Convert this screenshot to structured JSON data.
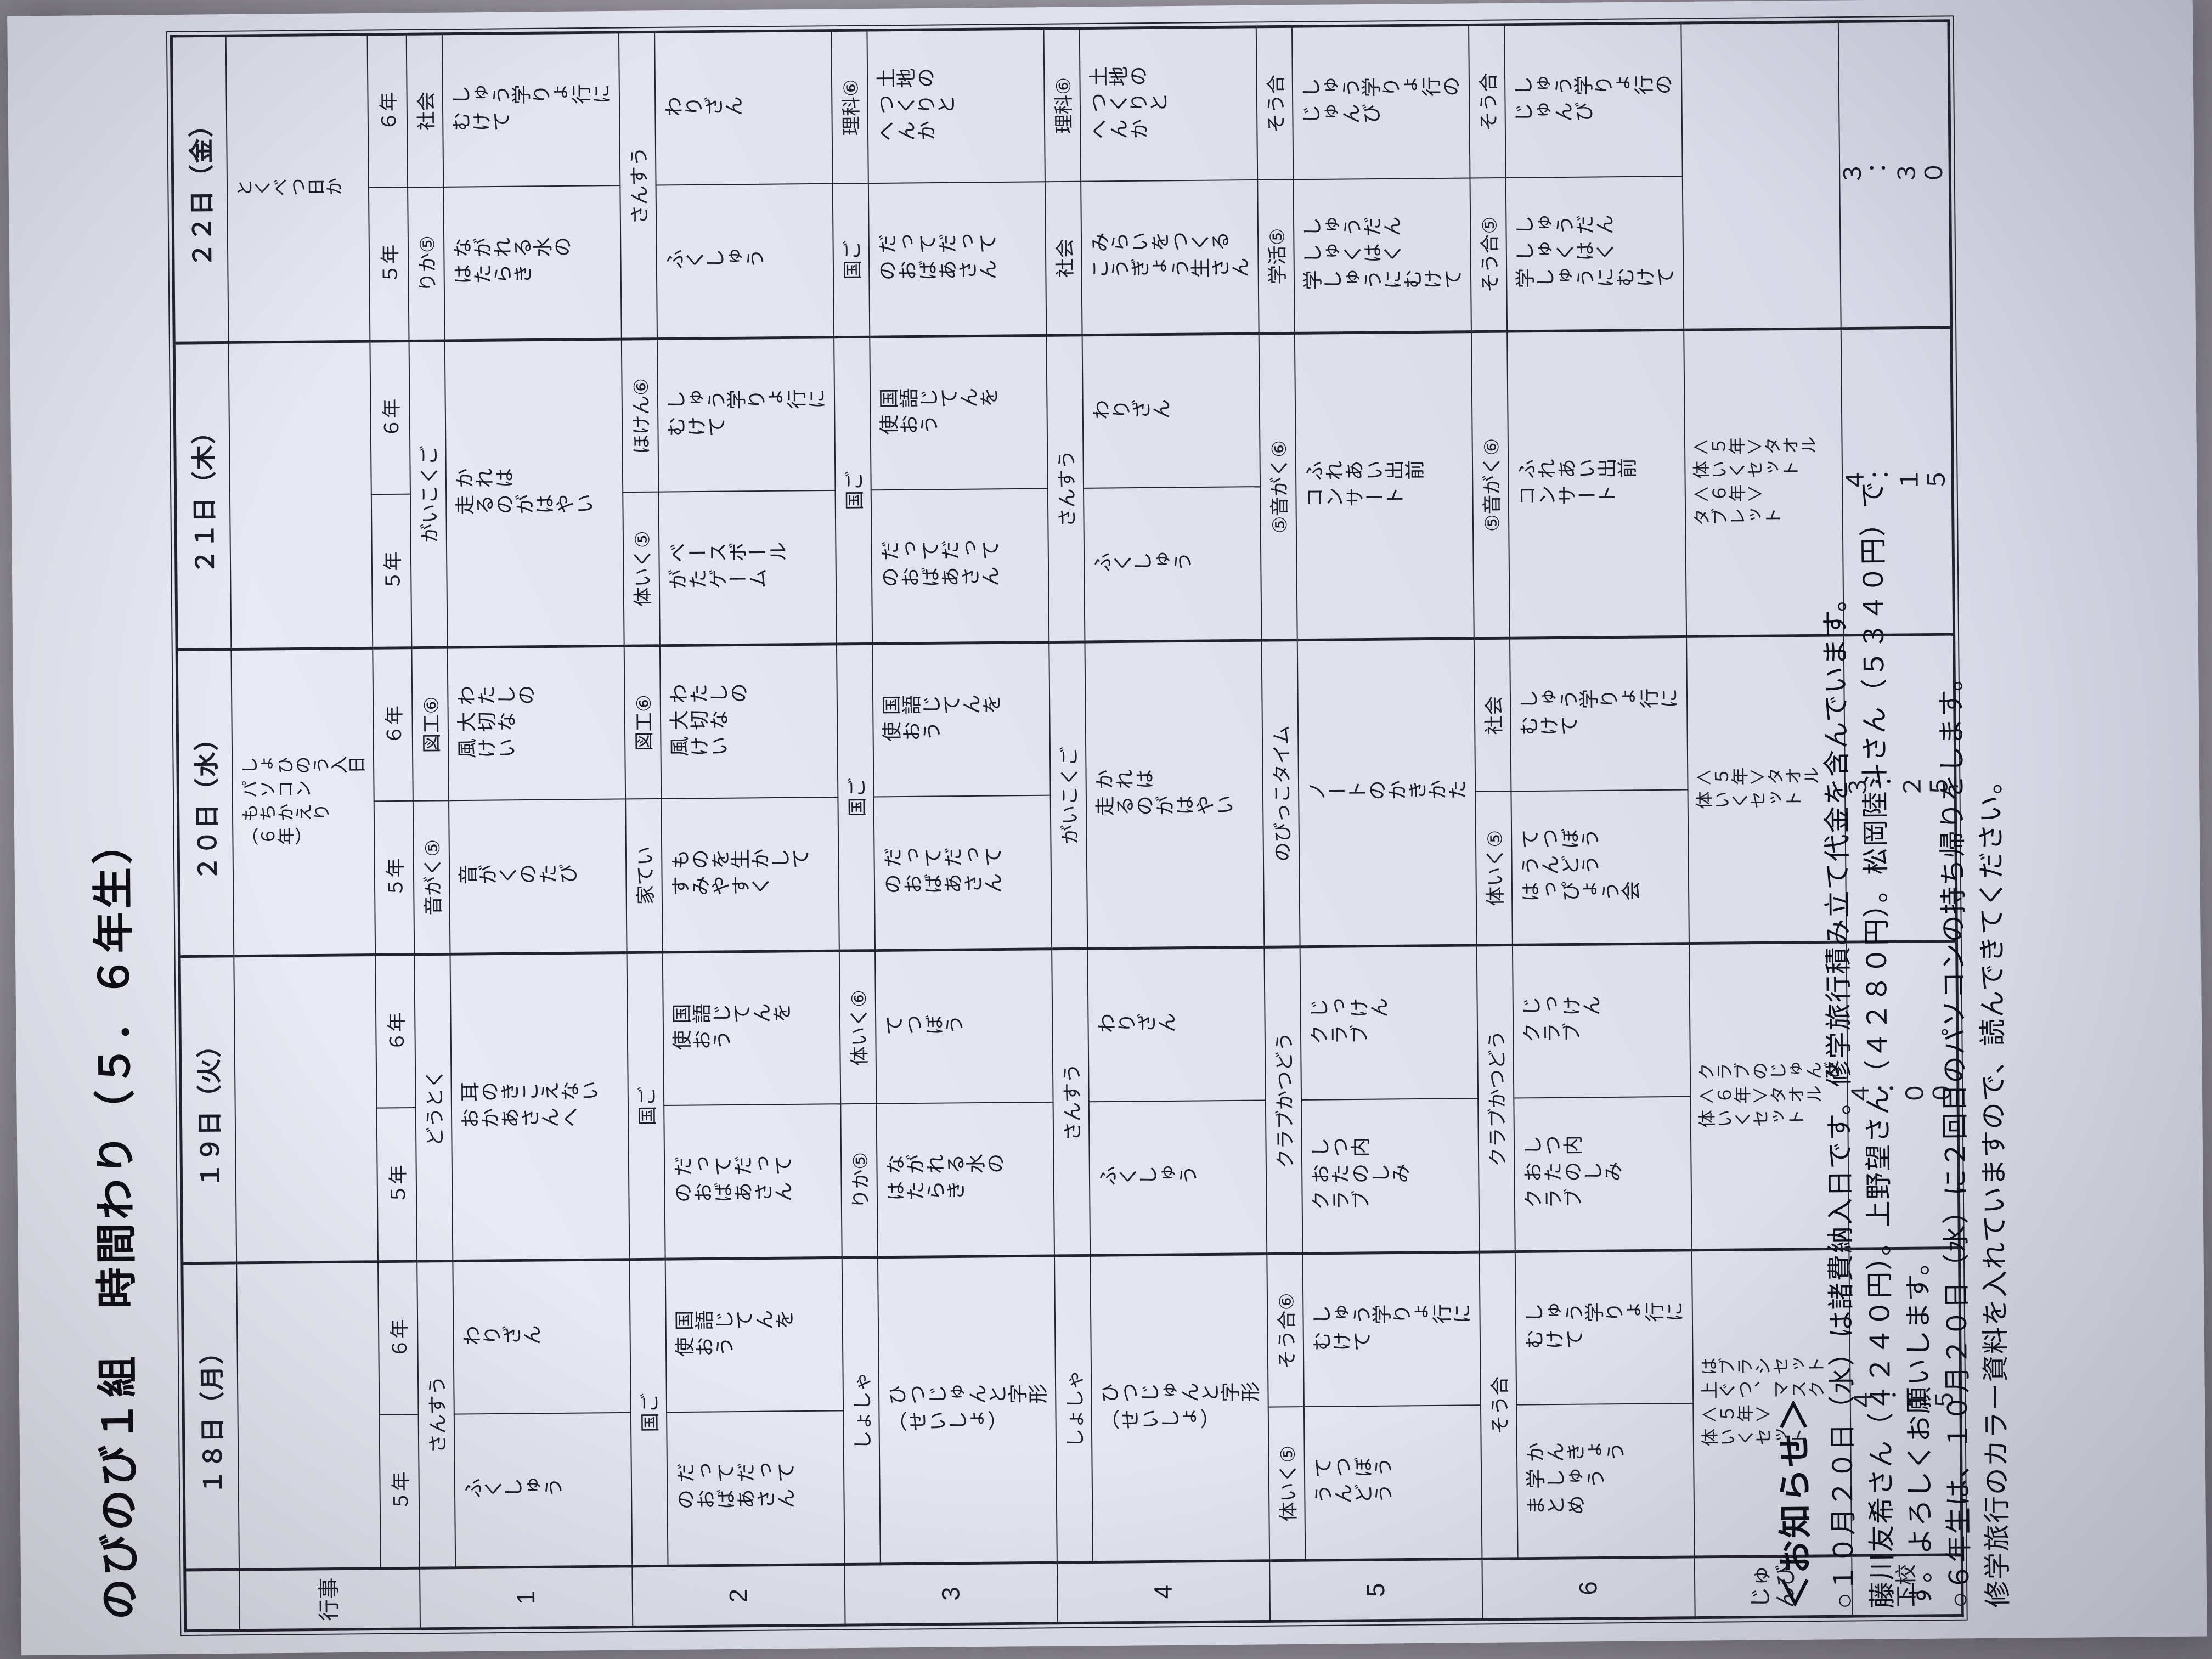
{
  "title": "のびのび１組　時間わり（５．６年生）",
  "colors": {
    "paper": "#e4e6f0",
    "ink": "#23232e",
    "photo_bg": "#a5a1aa"
  },
  "row_labels": {
    "event": "行事",
    "periods": [
      "1",
      "2",
      "3",
      "4",
      "5",
      "6"
    ],
    "prep": "じゅ\nんび",
    "dismissal": "下校"
  },
  "year_labels": {
    "y5": "５年",
    "y6": "６年"
  },
  "days": [
    {
      "date": "１８日（月）",
      "event": "",
      "periods": [
        {
          "merge": "subject",
          "subject": "さんすう",
          "t5": "ふくしゅう",
          "t6": "わりざん"
        },
        {
          "merge": "subject",
          "subject": "国ご",
          "t5": "だってだって\nのおばあさん",
          "t6": "国語じてんを\n使おう"
        },
        {
          "merge": "full",
          "subject": "しょしゃ",
          "topic": "ひつじゅんと字形\n（せいしょ）"
        },
        {
          "merge": "full",
          "subject": "しょしゃ",
          "topic": "ひつじゅんと字形\n（せいしょ）"
        },
        {
          "merge": "none",
          "s5": "体いく⑤",
          "t5": "てつぼう\nうんどう",
          "s6": "そう合⑥",
          "t6": "しゅう学りょ行に\nむけて"
        },
        {
          "merge": "subject",
          "subject": "そう合",
          "t5": "かんきょう\n学しゅう\nまとめ",
          "t6": "しゅう学りょ行に\nむけて"
        }
      ],
      "prep": "はブラシセット\n上ぐつ、マスク\n＜５年＞\n体いくセット",
      "dismissal": "４：１５"
    },
    {
      "date": "１９日（火）",
      "event": "",
      "periods": [
        {
          "merge": "full",
          "subject": "どうとく",
          "topic": "耳のきこえない\nおかあさんへ"
        },
        {
          "merge": "subject",
          "subject": "国ご",
          "t5": "だってだって\nのおばあさん",
          "t6": "国語じてんを\n使おう"
        },
        {
          "merge": "none",
          "s5": "りか⑤",
          "t5": "ながれる水の\nはたらき",
          "s6": "体いく⑥",
          "t6": "てつぼう"
        },
        {
          "merge": "subject",
          "subject": "さんすう",
          "t5": "ふくしゅう",
          "t6": "わりざん"
        },
        {
          "merge": "subject",
          "subject": "クラブかつどう",
          "t5": "しつ内\nおたのしみ\nクラブ",
          "t6": "じっけん\nクラブ"
        },
        {
          "merge": "subject",
          "subject": "クラブかつどう",
          "t5": "しつ内\nおたのしみ\nクラブ",
          "t6": "じっけん\nクラブ"
        }
      ],
      "prep": "クラブのじゅんび\n＜６年＞タオル\n体いくセット",
      "dismissal": "４：００"
    },
    {
      "date": "２０日（水）",
      "event": "しょひのう入日\nパソコン\nもちかえり\n（６年）",
      "periods": [
        {
          "merge": "none",
          "s5": "音がく⑤",
          "t5": "音がくのたび",
          "s6": "図工⑥",
          "t6": "わたしの\n大切な\n風けい"
        },
        {
          "merge": "none",
          "s5": "家てい",
          "t5": "ものを生かして\nすみやすく",
          "s6": "図工⑥",
          "t6": "わたしの\n大切な\n風けい"
        },
        {
          "merge": "subject",
          "subject": "国ご",
          "t5": "だってだって\nのおばあさん",
          "t6": "国語じてんを\n使おう"
        },
        {
          "merge": "full",
          "subject": "がいこくご",
          "topic": "かれは\n走るのがはやい"
        },
        {
          "merge": "full",
          "subject": "のびっこタイム",
          "topic": "ノートのかきかた"
        },
        {
          "merge": "none",
          "s5": "体いく⑤",
          "t5": "てつぼう\nうんどう\nはっぴょう会",
          "s6": "社会",
          "t6": "しゅう学りょ行に\nむけて"
        }
      ],
      "prep": "＜５年＞タオル\n体いくセット",
      "dismissal": "３：２５"
    },
    {
      "date": "２１日（木）",
      "event": "",
      "periods": [
        {
          "merge": "full",
          "subject": "がいこくご",
          "topic": "かれは\n走るのがはやい"
        },
        {
          "merge": "none",
          "s5": "体いく⑤",
          "t5": "ベースボール\nがたゲーム",
          "s6": "ほけん⑥",
          "t6": "しゅう学りょ行に\nむけて"
        },
        {
          "merge": "subject",
          "subject": "国ご",
          "t5": "だってだって\nのおばあさん",
          "t6": "国語じてんを\n使おう"
        },
        {
          "merge": "subject",
          "subject": "さんすう",
          "t5": "ふくしゅう",
          "t6": "わりざん"
        },
        {
          "merge": "full",
          "subject": "⑤音がく⑥",
          "topic": "ふれあい出前\nコンサート"
        },
        {
          "merge": "full",
          "subject": "⑤音がく⑥",
          "topic": "ふれあい出前\nコンサート"
        }
      ],
      "prep": "＜５年＞タオル\n体いくセット\n＜６年＞\nタブレット",
      "dismissal": "４：１５"
    },
    {
      "date": "２２日（金）",
      "event": "とくべつ日か",
      "periods": [
        {
          "merge": "none",
          "s5": "りか⑤",
          "t5": "ながれる水の\nはたらき",
          "s6": "社会",
          "t6": "しゅう学りょ行に\nむけて"
        },
        {
          "merge": "subject",
          "subject": "さんすう",
          "t5": "ふくしゅう",
          "t6": "わりざん"
        },
        {
          "merge": "none",
          "s5": "国ご",
          "t5": "だってだって\nのおばあさん",
          "s6": "理科⑥",
          "t6": "土地の\nつくりと\nへんか"
        },
        {
          "merge": "none",
          "s5": "社会",
          "t5": "みらいをつくる\nこうぎょう生さん",
          "s6": "理科⑥",
          "t6": "土地の\nつくりと\nへんか"
        },
        {
          "merge": "none",
          "s5": "学活⑤",
          "t5": "しゅうだん\nしゅくはく\n学しゅうにむけて",
          "s6": "そう合",
          "t6": "しゅう学りょ行の\nじゅんび"
        },
        {
          "merge": "none",
          "s5": "そう合⑤",
          "t5": "しゅうだん\nしゅくはく\n学しゅうにむけて",
          "s6": "そう合",
          "t6": "しゅう学りょ行の\nじゅんび"
        }
      ],
      "prep": "",
      "dismissal": "３：３０"
    }
  ],
  "notices": {
    "heading": "＜お知らせ＞",
    "lines": [
      "○１０月２０日（水）は諸費納入日です。修学旅行積み立て代金を含んでいます。",
      "藤川友希さん（４２４０円）。上野望さん（４２８０円）。松岡陸斗さん（５３４０円）で",
      "す。よろしくお願いします。",
      "○６年生は、１０月２０日（水）に２回目のパソコンの持ち帰りをします。",
      "修学旅行のカラー資料を入れていますので、読んできてください。"
    ]
  }
}
